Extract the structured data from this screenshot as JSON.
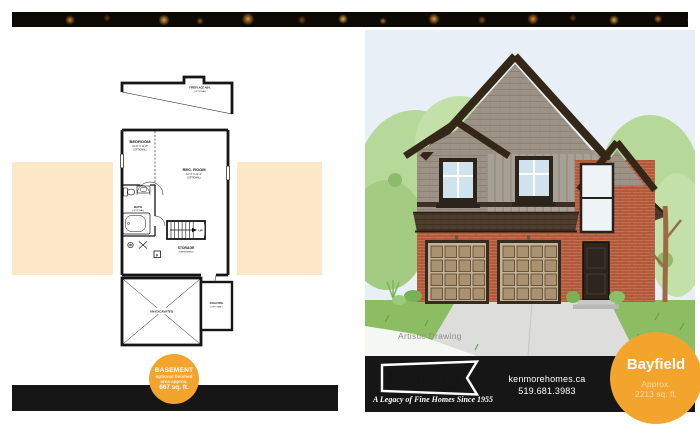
{
  "plan": {
    "fireplace": {
      "label": "FIREPLACE ABV.",
      "sub": "(OPTIONAL)"
    },
    "bedroom": {
      "label": "BEDROOM",
      "dims": "10'-6\" X 11'-8\"",
      "sub": "(OPTIONAL)"
    },
    "rec_room": {
      "label": "REC. ROOM",
      "dims": "14'-4\" X 22'-2\"",
      "sub": "(OPTIONAL)"
    },
    "bath": {
      "label": "BATH",
      "sub": "(OPTIONAL)"
    },
    "storage": {
      "label": "STORAGE",
      "sub": "(UNFINISHED)"
    },
    "unexcavated": {
      "label": "UN-EXCAVATED"
    },
    "cold_room": {
      "label": "COLD RM.",
      "sub": "(OPTIONAL)"
    },
    "stairs": {
      "up": "UP"
    },
    "furnace": {
      "label": "F"
    }
  },
  "basement_badge": {
    "title": "BASEMENT",
    "line1": "optional finished",
    "line2": "area approx.",
    "area": "667 sq. ft."
  },
  "illustration": {
    "caption": "Artistic Drawing"
  },
  "footer": {
    "brand": "Kenmore",
    "brand_sub": "HOMES",
    "tagline": "A Legacy of Fine Homes Since 1955",
    "website": "kenmorehomes.ca",
    "phone": "519.681.3983"
  },
  "model_badge": {
    "name": "Bayfield",
    "approx": "Approx.",
    "area": "2213 sq. ft."
  },
  "colors": {
    "accent_orange": "#F2A42C",
    "bar_black": "#161616",
    "band_peach": "#FCE7C7",
    "sky": "#E8EFF6"
  }
}
